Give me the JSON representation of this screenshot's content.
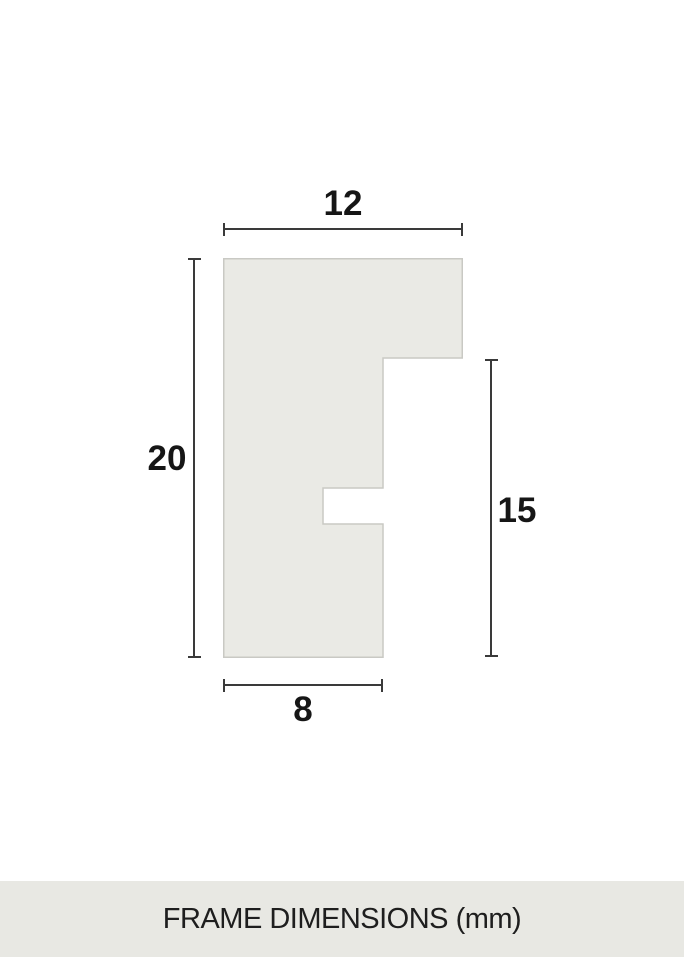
{
  "diagram": {
    "type": "frame-profile-cross-section",
    "dimensions": {
      "top_width": "12",
      "left_height": "20",
      "right_height": "15",
      "bottom_width": "8"
    },
    "colors": {
      "background": "#ffffff",
      "profile_fill": "#eaeae5",
      "profile_border": "#c9c9c4",
      "dimension_line": "#3a3a3a",
      "label_text": "#161616",
      "footer_background": "#e8e8e3",
      "footer_text": "#1e1e1e"
    }
  },
  "footer": {
    "label": "FRAME DIMENSIONS (mm)"
  }
}
